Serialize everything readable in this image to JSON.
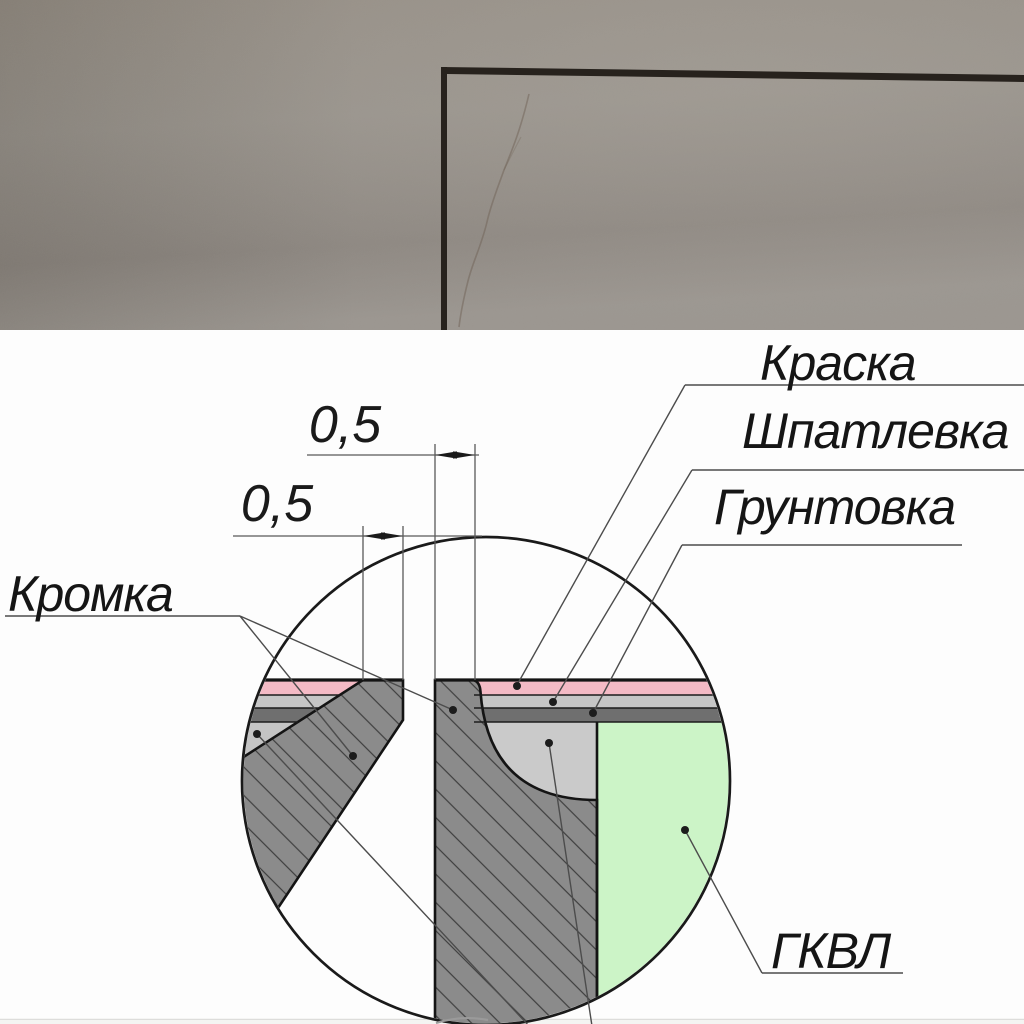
{
  "photo": {
    "wall_color": "#95908a",
    "marker_color": "#27221d"
  },
  "diagram": {
    "dimension_top": "0,5",
    "dimension_left": "0,5",
    "callouts": {
      "paint": "Краска",
      "filler": "Шпатлевка",
      "primer": "Грунтовка",
      "edge": "Кромка",
      "board": "ГКВЛ"
    },
    "colors": {
      "paint_layer": "#f4bac5",
      "filler_layer": "#c6c6c6",
      "filler_pocket": "#cacaca",
      "primer_layer": "#6f6f6f",
      "board_face": "#ccf4c7",
      "section_fill": "#8b8b8b",
      "edge_wedge": "#c4c4c4"
    }
  }
}
